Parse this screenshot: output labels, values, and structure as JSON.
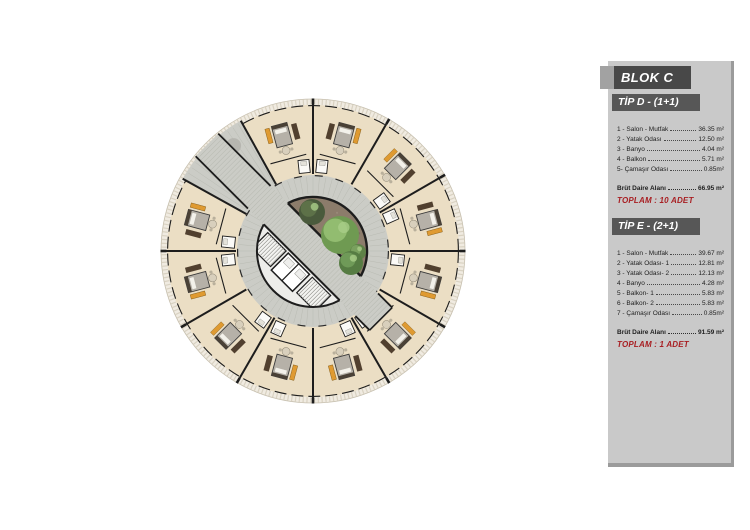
{
  "panel": {
    "block_title": "BLOK C",
    "sections": [
      {
        "title": "TİP D - (1+1)",
        "rooms": [
          {
            "label": "1 - Salon - Mutfak",
            "value": "36.35 m²"
          },
          {
            "label": "2 - Yatak Odası",
            "value": "12.50 m²"
          },
          {
            "label": "3 - Banyo",
            "value": "4.04 m²"
          },
          {
            "label": "4 - Balkon",
            "value": "5.71 m²"
          },
          {
            "label": "5- Çamaşır Odası",
            "value": "0.85m²"
          }
        ],
        "gross": {
          "label": "Brüt Daire Alanı",
          "value": "66.95 m²"
        },
        "total": "TOPLAM : 10  ADET"
      },
      {
        "title": "TİP E - (2+1)",
        "rooms": [
          {
            "label": "1 - Salon - Mutfak",
            "value": "39.67 m²"
          },
          {
            "label": "2 - Yatak Odası- 1",
            "value": "12.81 m²"
          },
          {
            "label": "3 - Yatak Odası- 2",
            "value": "12.13 m²"
          },
          {
            "label": "4 - Banyo",
            "value": "4.28 m²"
          },
          {
            "label": "5 - Balkon- 1",
            "value": "5.83 m²"
          },
          {
            "label": "6 - Balkon- 2",
            "value": "5.83 m²"
          },
          {
            "label": "7 - Çamaşır Odası",
            "value": "0.85m²"
          }
        ],
        "gross": {
          "label": "Brüt Daire Alanı",
          "value": "91.59 m²"
        },
        "total": "TOPLAM : 1 ADET"
      }
    ],
    "colors": {
      "panel_bg": "#c9c9c9",
      "bar_dark": "#4d4d4d",
      "accent_red": "#a81e22"
    }
  },
  "floor_plan": {
    "title": "Blok C dairesel kat planı",
    "center": {
      "x": 313,
      "y": 251
    },
    "radii": {
      "outer_rim": 152,
      "apartment_ring": 146,
      "corridor_ring": 76,
      "inner_circle": 56,
      "garden_border": 54
    },
    "sector_wall_angles_deg": [
      0,
      30,
      60,
      90,
      180,
      210,
      240,
      270,
      300,
      330
    ],
    "corridor_wedge": {
      "from_deg": 119,
      "to_deg": 151
    },
    "corridor_band": {
      "axis_deg": 135,
      "half_width": 16,
      "nw_length": 150,
      "se_length": 96
    },
    "apartments": [
      {
        "angle_deg": 15,
        "tip": "D"
      },
      {
        "angle_deg": 45,
        "tip": "D"
      },
      {
        "angle_deg": 75,
        "tip": "D"
      },
      {
        "angle_deg": 105,
        "tip": "E"
      },
      {
        "angle_deg": 165,
        "tip": "D"
      },
      {
        "angle_deg": 195,
        "tip": "D"
      },
      {
        "angle_deg": 225,
        "tip": "D"
      },
      {
        "angle_deg": 255,
        "tip": "D"
      },
      {
        "angle_deg": 285,
        "tip": "D"
      },
      {
        "angle_deg": 315,
        "tip": "D"
      },
      {
        "angle_deg": 345,
        "tip": "D"
      }
    ],
    "garden": {
      "soil_color": "#8c7c6b",
      "trees": [
        {
          "x": -1,
          "y": -39,
          "r": 13,
          "base": "#4a5a3c",
          "light": "#5d7148"
        },
        {
          "x": 27,
          "y": -16,
          "r": 19,
          "base": "#6f9a52",
          "light": "#92bc70"
        },
        {
          "x": 45,
          "y": 1,
          "r": 8,
          "base": "#5e8147",
          "light": "#79a05e"
        },
        {
          "x": 38,
          "y": 12,
          "r": 12,
          "base": "#567c43",
          "light": "#6f9a58"
        }
      ]
    },
    "colors": {
      "rim": "#f0ebe1",
      "rim_hatch": "#d9d2c2",
      "rim_edge": "#c6bfae",
      "apartment": "#ebdec4",
      "wall": "#1d1d1d",
      "corridor": "#cbccc6",
      "corridor_hatch": "#b9bbb3",
      "core": "#ededea",
      "stair": "#f3f3f0",
      "bed": "#b6b1a8",
      "pillow": "#f3f1ea",
      "headboard": "#4a4136",
      "wardrobe": "#df9a31",
      "sofa": "#51402f",
      "table": "#d8cfbc",
      "bath": "#fbfaf7",
      "shrub": "#b3b1ac"
    }
  }
}
